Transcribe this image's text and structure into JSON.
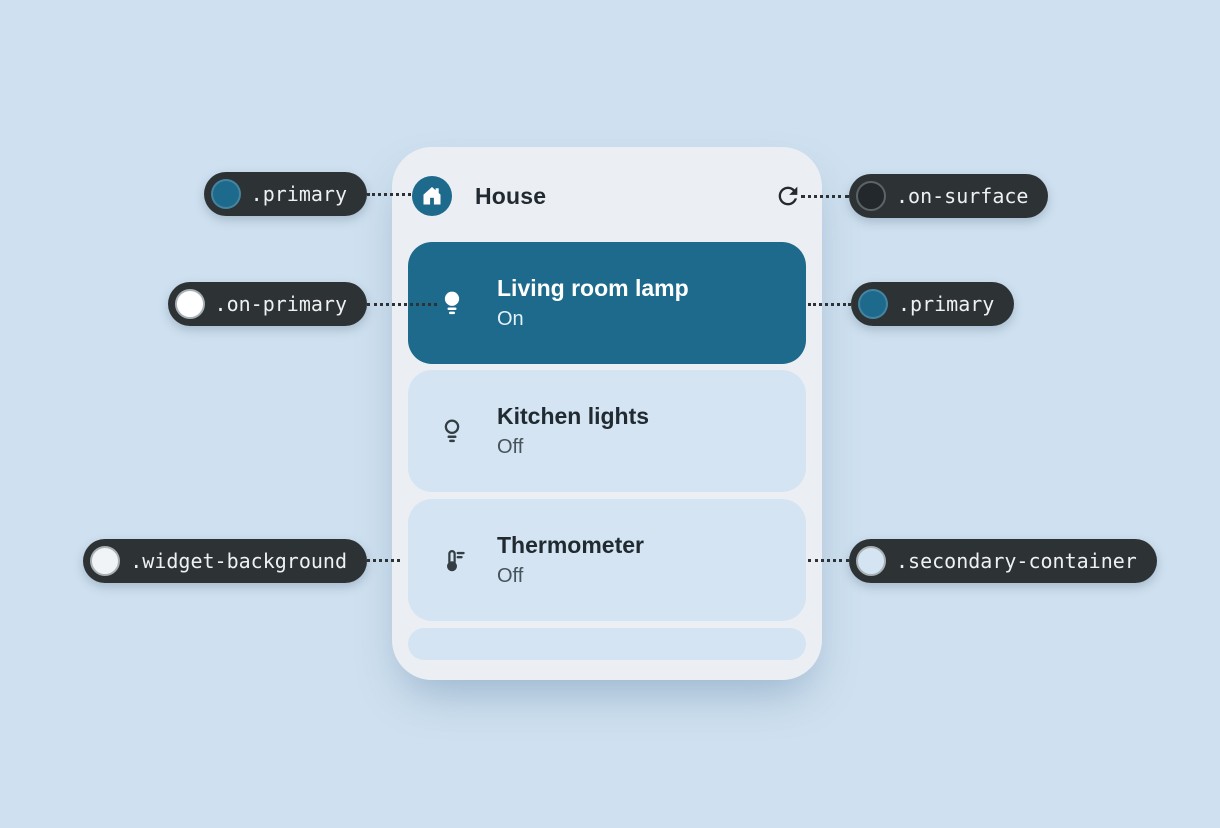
{
  "widget": {
    "title": "House",
    "header_icon": "home-icon",
    "refresh_icon": "refresh-icon",
    "devices": [
      {
        "name": "Living room lamp",
        "status": "On",
        "icon": "lightbulb-filled-icon",
        "active": true
      },
      {
        "name": "Kitchen lights",
        "status": "Off",
        "icon": "lightbulb-outline-icon",
        "active": false
      },
      {
        "name": "Thermometer",
        "status": "Off",
        "icon": "thermometer-icon",
        "active": false
      }
    ]
  },
  "callouts": {
    "left": [
      {
        "label": ".primary",
        "swatch": "#1d6a8c",
        "ring": "rgba(255,255,255,0.18)",
        "target": "home-icon"
      },
      {
        "label": ".on-primary",
        "swatch": "#ffffff",
        "ring": "#a9b1b5",
        "target": "lightbulb-filled-icon"
      },
      {
        "label": ".widget-background",
        "swatch": "#f1f4f7",
        "ring": "#a9b1b5",
        "target": "widget-card"
      }
    ],
    "right": [
      {
        "label": ".on-surface",
        "swatch": "#23282c",
        "ring": "#5d6468",
        "target": "refresh-icon"
      },
      {
        "label": ".primary",
        "swatch": "#1d6a8c",
        "ring": "rgba(255,255,255,0.18)",
        "target": "device-row-living-room-lamp"
      },
      {
        "label": ".secondary-container",
        "swatch": "#d4e4f3",
        "ring": "#a9b1b5",
        "target": "device-row-thermometer"
      }
    ]
  },
  "colors": {
    "page_background": "#cfe1f0",
    "widget_background": "#ebeff3",
    "primary": "#1d6a8c",
    "on_primary": "#ffffff",
    "on_surface": "#24292d",
    "secondary_container": "#d4e4f3",
    "callout_background": "#2d3235"
  }
}
